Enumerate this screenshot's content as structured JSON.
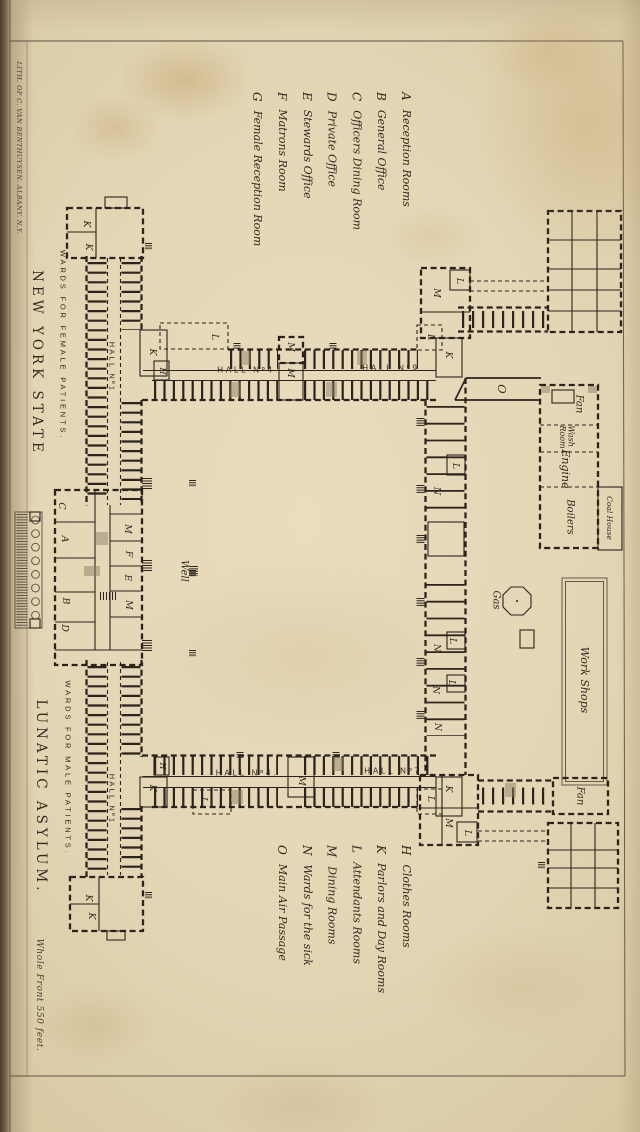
{
  "plate": {
    "lith_credit": "LITH. OF C. VAN BENTHUYSEN. ALBANY. N.Y.",
    "state_title": "NEW YORK STATE",
    "main_title": "LUNATIC ASYLUM.",
    "scale_note": "Whole Front 550 feet."
  },
  "colors": {
    "ink": "#2b231c",
    "paper": "#e3d6b5"
  },
  "legend_top": [
    {
      "key": "A",
      "label": "Reception Rooms"
    },
    {
      "key": "B",
      "label": "General Office"
    },
    {
      "key": "C",
      "label": "Officers Dining Room"
    },
    {
      "key": "D",
      "label": "Private Office"
    },
    {
      "key": "E",
      "label": "Stewards Office"
    },
    {
      "key": "F",
      "label": "Matrons Room"
    },
    {
      "key": "G",
      "label": "Female Reception Room"
    }
  ],
  "legend_bottom": [
    {
      "key": "H",
      "label": "Clothes Rooms"
    },
    {
      "key": "K",
      "label": "Parlors and Day Rooms"
    },
    {
      "key": "L",
      "label": "Attendants Rooms"
    },
    {
      "key": "M",
      "label": "Dining Rooms"
    },
    {
      "key": "N",
      "label": "Wards for the sick"
    },
    {
      "key": "O",
      "label": "Main Air Passage"
    }
  ],
  "plan": {
    "room_labels": [
      {
        "t": "K",
        "x": 86,
        "y": 224
      },
      {
        "t": "K",
        "x": 88,
        "y": 247
      },
      {
        "t": "WARDS FOR FEMALE PATIENTS.",
        "x": 63,
        "y": 345,
        "c": "wards"
      },
      {
        "t": "HALL Nº1",
        "x": 112,
        "y": 367,
        "c": "hallv"
      },
      {
        "t": "K",
        "x": 152,
        "y": 352
      },
      {
        "t": "H",
        "x": 162,
        "y": 371,
        "c": "sm"
      },
      {
        "t": "L",
        "x": 214,
        "y": 337
      },
      {
        "t": "HALL Nº4",
        "x": 246,
        "y": 370,
        "c": "hall"
      },
      {
        "t": "M",
        "x": 290,
        "y": 347
      },
      {
        "t": "M",
        "x": 290,
        "y": 373
      },
      {
        "t": "HALL Nº9",
        "x": 391,
        "y": 368,
        "c": "hall"
      },
      {
        "t": "L",
        "x": 430,
        "y": 337
      },
      {
        "t": "K",
        "x": 448,
        "y": 355
      },
      {
        "t": "M",
        "x": 436,
        "y": 293
      },
      {
        "t": "L",
        "x": 459,
        "y": 281
      },
      {
        "t": "O",
        "x": 502,
        "y": 389,
        "c": "o"
      },
      {
        "t": "L",
        "x": 455,
        "y": 466
      },
      {
        "t": "N",
        "x": 436,
        "y": 491
      },
      {
        "t": "C",
        "x": 61,
        "y": 506
      },
      {
        "t": "A",
        "x": 64,
        "y": 539
      },
      {
        "t": "B",
        "x": 65,
        "y": 601
      },
      {
        "t": "D",
        "x": 64,
        "y": 628
      },
      {
        "t": "M",
        "x": 127,
        "y": 529
      },
      {
        "t": "F",
        "x": 128,
        "y": 554
      },
      {
        "t": "E",
        "x": 127,
        "y": 578
      },
      {
        "t": "M",
        "x": 128,
        "y": 605
      },
      {
        "t": "Well",
        "x": 183,
        "y": 571,
        "c": "bname"
      },
      {
        "t": "WARDS FOR MALE PATIENTS.",
        "x": 68,
        "y": 768,
        "c": "wards"
      },
      {
        "t": "HALL Nº1",
        "x": 112,
        "y": 799,
        "c": "hallv"
      },
      {
        "t": "K",
        "x": 88,
        "y": 898
      },
      {
        "t": "K",
        "x": 91,
        "y": 916
      },
      {
        "t": "H",
        "x": 162,
        "y": 766,
        "c": "sm"
      },
      {
        "t": "K",
        "x": 152,
        "y": 788
      },
      {
        "t": "L",
        "x": 203,
        "y": 800
      },
      {
        "t": "HALL Nº4.",
        "x": 247,
        "y": 773,
        "c": "hall"
      },
      {
        "t": "M",
        "x": 301,
        "y": 781
      },
      {
        "t": "HALL Nº7",
        "x": 393,
        "y": 771,
        "c": "hall"
      },
      {
        "t": "L",
        "x": 430,
        "y": 799
      },
      {
        "t": "K",
        "x": 448,
        "y": 789
      },
      {
        "t": "M",
        "x": 448,
        "y": 823
      },
      {
        "t": "L",
        "x": 467,
        "y": 833
      },
      {
        "t": "N",
        "x": 436,
        "y": 648
      },
      {
        "t": "L",
        "x": 452,
        "y": 641
      },
      {
        "t": "N",
        "x": 435,
        "y": 690
      },
      {
        "t": "L",
        "x": 451,
        "y": 683
      },
      {
        "t": "N",
        "x": 437,
        "y": 727
      },
      {
        "t": "Fan",
        "x": 578,
        "y": 404,
        "c": "bname"
      },
      {
        "t": "Wash\nRoom",
        "x": 566,
        "y": 437,
        "c": "sm2"
      },
      {
        "t": "Engine",
        "x": 565,
        "y": 469,
        "c": "bname lg"
      },
      {
        "t": "Boilers",
        "x": 569,
        "y": 517,
        "c": "bname"
      },
      {
        "t": "Coal House",
        "x": 609,
        "y": 518,
        "c": "xs"
      },
      {
        "t": "Gas",
        "x": 495,
        "y": 600,
        "c": "bname"
      },
      {
        "t": "Work Shops",
        "x": 584,
        "y": 680,
        "c": "bname lg"
      },
      {
        "t": "Fan",
        "x": 579,
        "y": 796,
        "c": "bname"
      }
    ]
  }
}
